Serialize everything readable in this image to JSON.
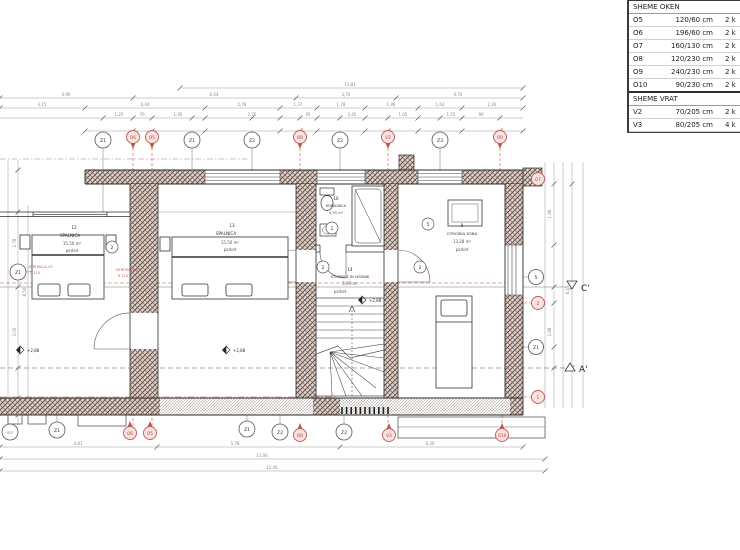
{
  "legend": {
    "windows_title": "SHEME OKEN",
    "doors_title": "SHEME VRAT",
    "windows": [
      {
        "code": "O5",
        "size": "120/60 cm",
        "qty": "2 k"
      },
      {
        "code": "O6",
        "size": "196/60 cm",
        "qty": "2 k"
      },
      {
        "code": "O7",
        "size": "160/130 cm",
        "qty": "2 k"
      },
      {
        "code": "O8",
        "size": "120/230 cm",
        "qty": "2 k"
      },
      {
        "code": "O9",
        "size": "240/230 cm",
        "qty": "2 k"
      },
      {
        "code": "O10",
        "size": "90/230 cm",
        "qty": "2 k"
      }
    ],
    "doors": [
      {
        "code": "V2",
        "size": "70/205 cm",
        "qty": "2 k"
      },
      {
        "code": "V3",
        "size": "80/205 cm",
        "qty": "4 k"
      }
    ]
  },
  "rooms": {
    "left": {
      "num": "12",
      "name": "SPALNICA",
      "area": "15,50 m²",
      "floor": "parket"
    },
    "mid": {
      "num": "13",
      "name": "SPALNICA",
      "area": "15,50 m²",
      "floor": "parket"
    },
    "bath": {
      "num": "16",
      "name": "KOPALNICA",
      "area": "4,95 m²"
    },
    "hall": {
      "num": "14",
      "name": "STOPNICE IN HODNIK",
      "area": "5,95 m²",
      "floor": "parket"
    },
    "kids": {
      "num": "9",
      "name": "OTROŠKA SOBA",
      "area": "13,28 m²",
      "floor": "parket"
    }
  },
  "bubbles": {
    "t": [
      "Z1",
      "O6",
      "O5",
      "Z1",
      "Z2",
      "O8",
      "Z2",
      "V2",
      "Z3",
      "O9"
    ],
    "b": [
      "011",
      "Z1",
      "O6",
      "O5",
      "Z1",
      "Z2",
      "O8",
      "Z2",
      "V3",
      "O10"
    ],
    "r": [
      "O7",
      "5",
      "2",
      "Z1",
      "1"
    ],
    "l": [
      "Z1"
    ],
    "i": [
      "2",
      "2",
      "1",
      "5",
      "2"
    ]
  },
  "sections": {
    "c": "C'",
    "a": "A'"
  },
  "levels": {
    "v1": "+2,88",
    "v2": "+2,88",
    "v3": "+2,88"
  },
  "notes": {
    "n1a": "VERTIKALA V1",
    "n1b": "fi 110",
    "n2a": "VERTIKALA V1",
    "n2b": "fi 110"
  },
  "dims": {
    "a1": "11,81",
    "b1": "4,90",
    "b2": "6,04",
    "b3": "3,70",
    "b4": "4,70",
    "c1": "3,15",
    "c2": "4,44",
    "c3": "2,78",
    "c4": "1,37",
    "c5": "1,78",
    "c6": "1,96",
    "c7": "1,63",
    "c8": "2,26",
    "d1": "1,25",
    "d2": "70",
    "d3": "1,95",
    "d4": "2,70",
    "d5": "95",
    "d6": "2,45",
    "d7": "1,05",
    "d8": "1,55",
    "d9": "90",
    "l1": "2,78",
    "l2": "3,05",
    "l3": "8,50",
    "r1": "1,66",
    "r2": "2,98",
    "r3": "8,41",
    "f1": "4,81",
    "f2": "5,78",
    "f3": "6,30",
    "f4": "11,06",
    "f5": "12,45"
  },
  "colors": {
    "accent_red": "#b5453c",
    "wall_hatch": "#8e4a40",
    "line": "#2f2f2f",
    "dim": "#8a8a8a"
  }
}
